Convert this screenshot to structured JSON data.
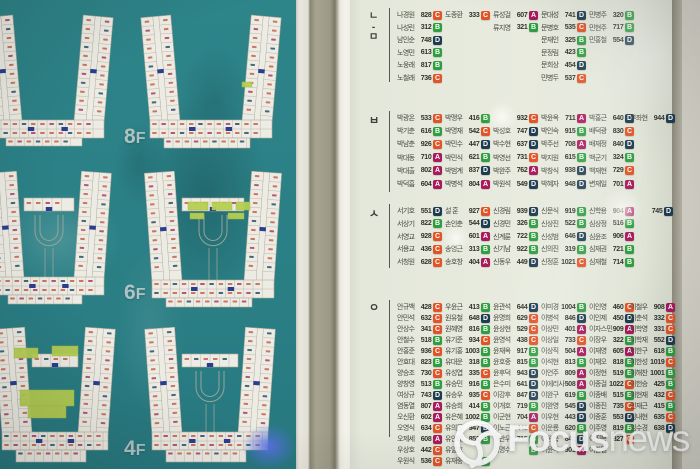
{
  "left_panel": {
    "floor_labels": [
      "8F",
      "6F",
      "4F"
    ],
    "board_color": "#2b8085",
    "plan_color": "#edece4",
    "highlight_green": "#b7cf52"
  },
  "right_panel": {
    "badge_colors": {
      "A": "#a81a5c",
      "B": "#2e9e3e",
      "C": "#e25427",
      "D": "#1e3c50"
    },
    "sections": [
      {
        "label": "ㄴ-ㅁ",
        "entries": [
          [
            1,
            1,
            "나경원",
            "828",
            "C"
          ],
          [
            1,
            2,
            "나성린",
            "312",
            "B"
          ],
          [
            1,
            3,
            "남인순",
            "748",
            "D"
          ],
          [
            1,
            4,
            "노영민",
            "613",
            "B"
          ],
          [
            1,
            5,
            "노웅래",
            "817",
            "B"
          ],
          [
            1,
            6,
            "노철래",
            "736",
            "C"
          ],
          [
            2,
            1,
            "도종환",
            "333",
            "C"
          ],
          [
            3,
            1,
            "류성걸",
            "607",
            "A"
          ],
          [
            3,
            2,
            "류지영",
            "321",
            "B"
          ],
          [
            4,
            1,
            "문대성",
            "741",
            "D"
          ],
          [
            4,
            2,
            "문병호",
            "535",
            "C"
          ],
          [
            4,
            3,
            "문재인",
            "325",
            "B"
          ],
          [
            4,
            4,
            "문정림",
            "423",
            "B"
          ],
          [
            4,
            5,
            "문희상",
            "454",
            "D"
          ],
          [
            4,
            6,
            "민병두",
            "537",
            "C"
          ],
          [
            5,
            1,
            "민병주",
            "320",
            "B"
          ],
          [
            5,
            2,
            "민현주",
            "717",
            "B"
          ],
          [
            5,
            3,
            "민홍철",
            "554",
            "D"
          ]
        ]
      },
      {
        "label": "ㅂ",
        "entries": [
          [
            1,
            1,
            "박광온",
            "533",
            "C"
          ],
          [
            1,
            2,
            "박기춘",
            "616",
            "B"
          ],
          [
            1,
            3,
            "박남춘",
            "926",
            "C"
          ],
          [
            1,
            4,
            "박대동",
            "710",
            "A"
          ],
          [
            1,
            5,
            "박대출",
            "802",
            "A"
          ],
          [
            1,
            6,
            "박덕흠",
            "604",
            "A"
          ],
          [
            2,
            1,
            "박맹우",
            "416",
            "B"
          ],
          [
            2,
            2,
            "박명재",
            "542",
            "C"
          ],
          [
            2,
            3,
            "박민수",
            "447",
            "D"
          ],
          [
            2,
            4,
            "박민식",
            "621",
            "B"
          ],
          [
            2,
            5,
            "박범계",
            "837",
            "D"
          ],
          [
            2,
            6,
            "박병석",
            "804",
            "A"
          ],
          [
            3,
            1,
            "",
            "932",
            "C"
          ],
          [
            3,
            2,
            "박성호",
            "747",
            "D"
          ],
          [
            3,
            3,
            "박수현",
            "637",
            "D"
          ],
          [
            3,
            4,
            "박영선",
            "731",
            "C"
          ],
          [
            3,
            5,
            "박완주",
            "762",
            "A"
          ],
          [
            3,
            6,
            "박원석",
            "549",
            "D"
          ],
          [
            4,
            1,
            "박윤옥",
            "711",
            "A"
          ],
          [
            4,
            2,
            "박인숙",
            "915",
            "B"
          ],
          [
            4,
            3,
            "박주선",
            "708",
            "A"
          ],
          [
            4,
            4,
            "박지원",
            "615",
            "B"
          ],
          [
            4,
            5,
            "박창식",
            "938",
            "D"
          ],
          [
            4,
            6,
            "박혜자",
            "948",
            "D"
          ],
          [
            5,
            1,
            "박홍근",
            "640",
            "D"
          ],
          [
            5,
            2,
            "배덕광",
            "830",
            "C"
          ],
          [
            5,
            3,
            "배재정",
            "840",
            "D"
          ],
          [
            5,
            4,
            "백군기",
            "324",
            "B"
          ],
          [
            5,
            5,
            "백재현",
            "729",
            "C"
          ],
          [
            5,
            6,
            "변재일",
            "701",
            "A"
          ],
          [
            6,
            1,
            "부좌현",
            "944",
            "D"
          ]
        ]
      },
      {
        "label": "ㅅ",
        "entries": [
          [
            1,
            1,
            "서기호",
            "551",
            "D"
          ],
          [
            1,
            2,
            "서상기",
            "822",
            "B"
          ],
          [
            1,
            3,
            "서영교",
            "928",
            "C"
          ],
          [
            1,
            4,
            "서용교",
            "436",
            "C"
          ],
          [
            1,
            5,
            "서청원",
            "628",
            "C"
          ],
          [
            2,
            1,
            "설 훈",
            "927",
            "C"
          ],
          [
            2,
            2,
            "손인춘",
            "544",
            "D"
          ],
          [
            2,
            3,
            "",
            "601",
            "A"
          ],
          [
            2,
            4,
            "송영근",
            "313",
            "B"
          ],
          [
            2,
            5,
            "송호창",
            "404",
            "A"
          ],
          [
            3,
            1,
            "신경림",
            "939",
            "D"
          ],
          [
            3,
            2,
            "신경민",
            "326",
            "B"
          ],
          [
            3,
            3,
            "신계륜",
            "722",
            "B"
          ],
          [
            3,
            4,
            "신기남",
            "922",
            "B"
          ],
          [
            3,
            5,
            "신동우",
            "449",
            "D"
          ],
          [
            4,
            1,
            "신문식",
            "919",
            "B"
          ],
          [
            4,
            2,
            "신상진",
            "522",
            "B"
          ],
          [
            4,
            3,
            "신성범",
            "646",
            "D"
          ],
          [
            4,
            4,
            "신의진",
            "319",
            "B"
          ],
          [
            4,
            5,
            "신정훈",
            "1021",
            "C"
          ],
          [
            5,
            1,
            "신학용",
            "904",
            "A"
          ],
          [
            5,
            2,
            "심상정",
            "516",
            "B"
          ],
          [
            5,
            3,
            "심윤조",
            "906",
            "A"
          ],
          [
            5,
            4,
            "심재권",
            "721",
            "B"
          ],
          [
            5,
            5,
            "심재철",
            "714",
            "B"
          ],
          [
            7,
            1,
            "",
            "745",
            "D"
          ]
        ]
      },
      {
        "label": "ㅇ",
        "entries": [
          [
            1,
            1,
            "안규백",
            "428",
            "C"
          ],
          [
            1,
            2,
            "안민석",
            "632",
            "C"
          ],
          [
            1,
            3,
            "안상수",
            "341",
            "C"
          ],
          [
            1,
            4,
            "안철수",
            "518",
            "B"
          ],
          [
            1,
            5,
            "안홍준",
            "936",
            "C"
          ],
          [
            1,
            6,
            "안효대",
            "823",
            "B"
          ],
          [
            1,
            7,
            "양승조",
            "730",
            "C"
          ],
          [
            1,
            8,
            "양창영",
            "513",
            "B"
          ],
          [
            1,
            9,
            "여상규",
            "743",
            "D"
          ],
          [
            1,
            10,
            "염동열",
            "807",
            "A"
          ],
          [
            1,
            11,
            "오신환",
            "602",
            "A"
          ],
          [
            1,
            12,
            "오영식",
            "634",
            "C"
          ],
          [
            1,
            13,
            "오제세",
            "608",
            "A"
          ],
          [
            1,
            14,
            "우상호",
            "442",
            "C"
          ],
          [
            1,
            15,
            "우원식",
            "536",
            "C"
          ],
          [
            2,
            1,
            "우윤근",
            "413",
            "B"
          ],
          [
            2,
            2,
            "원유철",
            "648",
            "D"
          ],
          [
            2,
            3,
            "원혜영",
            "816",
            "B"
          ],
          [
            2,
            4,
            "유기준",
            "934",
            "C"
          ],
          [
            2,
            5,
            "유기홍",
            "1003",
            "B"
          ],
          [
            2,
            6,
            "유대운",
            "318",
            "B"
          ],
          [
            2,
            7,
            "유성엽",
            "335",
            "C"
          ],
          [
            2,
            8,
            "유승민",
            "916",
            "B"
          ],
          [
            2,
            9,
            "유승우",
            "935",
            "C"
          ],
          [
            2,
            10,
            "유승희",
            "414",
            "B"
          ],
          [
            2,
            11,
            "유은혜",
            "1002",
            "B"
          ],
          [
            2,
            12,
            "유의동",
            "947",
            "D"
          ],
          [
            2,
            13,
            "유인태",
            "852",
            "B"
          ],
          [
            2,
            14,
            "유일호",
            "",
            ""
          ],
          [
            2,
            15,
            "유재중",
            "",
            "B"
          ],
          [
            3,
            1,
            "윤관석",
            "644",
            "D"
          ],
          [
            3,
            2,
            "윤명희",
            "629",
            "C"
          ],
          [
            3,
            3,
            "윤상현",
            "529",
            "C"
          ],
          [
            3,
            4,
            "윤영석",
            "438",
            "C"
          ],
          [
            3,
            5,
            "윤재옥",
            "917",
            "B"
          ],
          [
            3,
            6,
            "윤호중",
            "815",
            "B"
          ],
          [
            3,
            7,
            "윤후덕",
            "943",
            "D"
          ],
          [
            3,
            8,
            "은수미",
            "641",
            "D"
          ],
          [
            3,
            9,
            "이강후",
            "847",
            "D"
          ],
          [
            3,
            10,
            "이개호",
            "719",
            "B"
          ],
          [
            3,
            11,
            "이군현",
            "704",
            "A"
          ],
          [
            3,
            12,
            "이노근",
            "441",
            "C"
          ],
          [
            3,
            13,
            "이만우",
            "715",
            "B"
          ],
          [
            3,
            14,
            "이명수",
            "",
            "B"
          ],
          [
            4,
            1,
            "이미경",
            "1004",
            "B"
          ],
          [
            4,
            2,
            "이병석",
            "846",
            "D"
          ],
          [
            4,
            3,
            "이상민",
            "401",
            "A"
          ],
          [
            4,
            4,
            "이상일",
            "733",
            "C"
          ],
          [
            4,
            5,
            "이상직",
            "504",
            "A"
          ],
          [
            4,
            6,
            "이석현",
            "813",
            "B"
          ],
          [
            4,
            7,
            "이언주",
            "809",
            "A"
          ],
          [
            4,
            8,
            "이에리사",
            "508",
            "A"
          ],
          [
            4,
            9,
            "이완구",
            "619",
            "B"
          ],
          [
            4,
            10,
            "이완영",
            "545",
            "D"
          ],
          [
            4,
            11,
            "이우현",
            "443",
            "D"
          ],
          [
            4,
            12,
            "이운룡",
            "620",
            "B"
          ],
          [
            4,
            13,
            "이원욱",
            "841",
            "D"
          ],
          [
            4,
            14,
            "이윤석",
            "901",
            "A"
          ],
          [
            5,
            1,
            "이인영",
            "460",
            "C"
          ],
          [
            5,
            2,
            "이인제",
            "450",
            "D"
          ],
          [
            5,
            3,
            "이자스민",
            "909",
            "A"
          ],
          [
            5,
            4,
            "이장우",
            "322",
            "B"
          ],
          [
            5,
            5,
            "이재영",
            "605",
            "A"
          ],
          [
            5,
            6,
            "이재오",
            "818",
            "B"
          ],
          [
            5,
            7,
            "이정현",
            "519",
            "B"
          ],
          [
            5,
            8,
            "이종걸",
            "1022",
            "C"
          ],
          [
            5,
            9,
            "이종배",
            "515",
            "B"
          ],
          [
            5,
            10,
            "이종진",
            "735",
            "C"
          ],
          [
            5,
            11,
            "이종훈",
            "553",
            "D"
          ],
          [
            5,
            12,
            "이주영",
            "819",
            "B"
          ],
          [
            5,
            13,
            "이진복",
            "827",
            "C"
          ],
          [
            5,
            14,
            "이찬열",
            "",
            ""
          ],
          [
            6,
            1,
            "이철우",
            "908",
            "A"
          ],
          [
            6,
            2,
            "이춘석",
            "332",
            "C"
          ],
          [
            6,
            3,
            "이학영",
            "331",
            "C"
          ],
          [
            6,
            4,
            "이학재",
            "552",
            "D"
          ],
          [
            6,
            5,
            "이한구",
            "618",
            "B"
          ],
          [
            6,
            6,
            "이한성",
            "1019",
            "C"
          ],
          [
            6,
            7,
            "이해찬",
            "1001",
            "B"
          ],
          [
            6,
            8,
            "이헌승",
            "425",
            "B"
          ],
          [
            6,
            9,
            "이현재",
            "432",
            "C"
          ],
          [
            6,
            10,
            "인재근",
            "415",
            "B"
          ],
          [
            6,
            11,
            "임내현",
            "635",
            "C"
          ],
          [
            6,
            12,
            "임수경",
            "638",
            "D"
          ]
        ]
      }
    ]
  },
  "watermark": {
    "brand_bold": "Focus",
    "brand_light": "news"
  }
}
